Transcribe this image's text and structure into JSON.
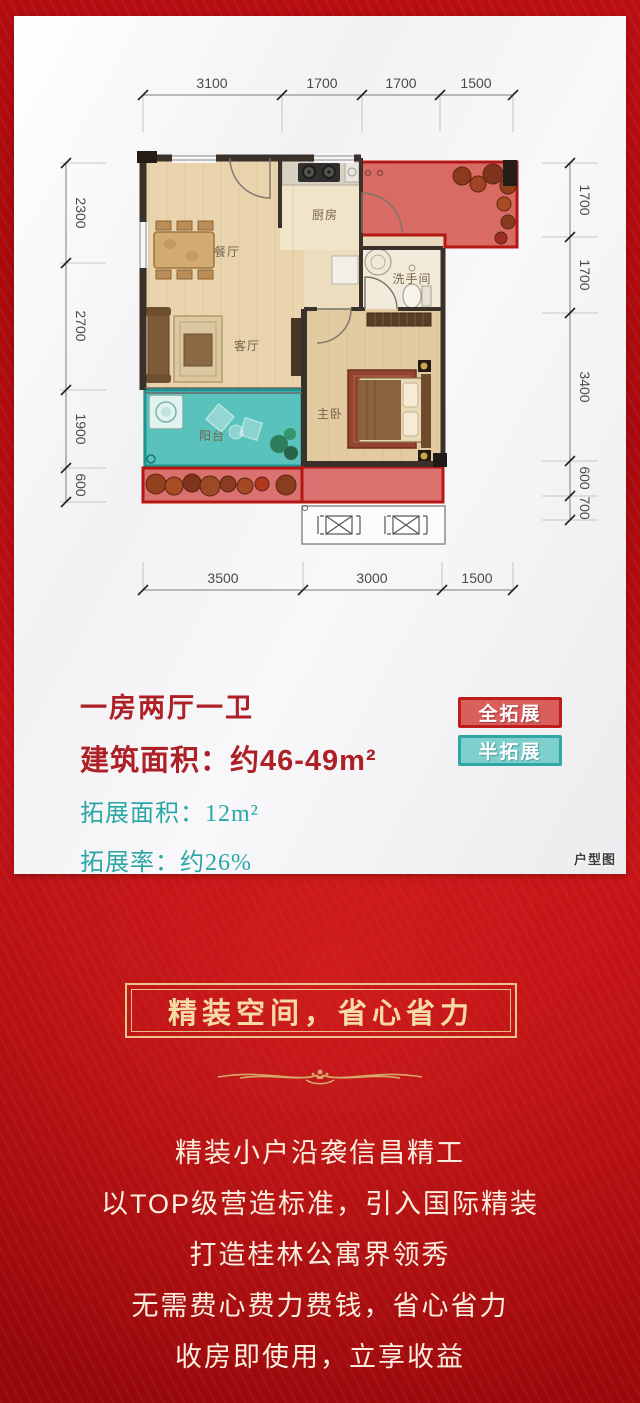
{
  "plan": {
    "corner_label": "户型图",
    "rooms": {
      "dining": "餐厅",
      "kitchen": "厨房",
      "living": "客厅",
      "bath": "洗手间",
      "bedroom": "主卧",
      "balcony": "阳台"
    },
    "dims": {
      "top": [
        "3100",
        "1700",
        "1700",
        "1500"
      ],
      "left": [
        "2300",
        "2700",
        "1900",
        "600"
      ],
      "right": [
        "1700",
        "1700",
        "3400",
        "600",
        "700"
      ],
      "bottom": [
        "3500",
        "3000",
        "1500"
      ]
    }
  },
  "info": {
    "layout": "一房两厅一卫",
    "build_area": "建筑面积：约46-49m²",
    "ext_area_label": "拓展面积：",
    "ext_area_value": "12m²",
    "ext_rate_label": "拓展率：",
    "ext_rate_value": "约26%"
  },
  "legend": {
    "full": "全拓展",
    "half": "半拓展"
  },
  "banner": {
    "title": "精装空间，省心省力"
  },
  "body": {
    "lines": [
      "精装小户沿袭信昌精工",
      "以TOP级营造标准，引入国际精装",
      "打造桂林公寓界领秀",
      "无需费心费力费钱，省心省力",
      "收房即使用，立享收益"
    ]
  },
  "colors": {
    "accent_red": "#ad2126",
    "teal": "#2aa7a5",
    "gold": "#eecb90",
    "full_ext_fill": "#d4504e",
    "half_ext_fill": "#4cc0bd"
  }
}
